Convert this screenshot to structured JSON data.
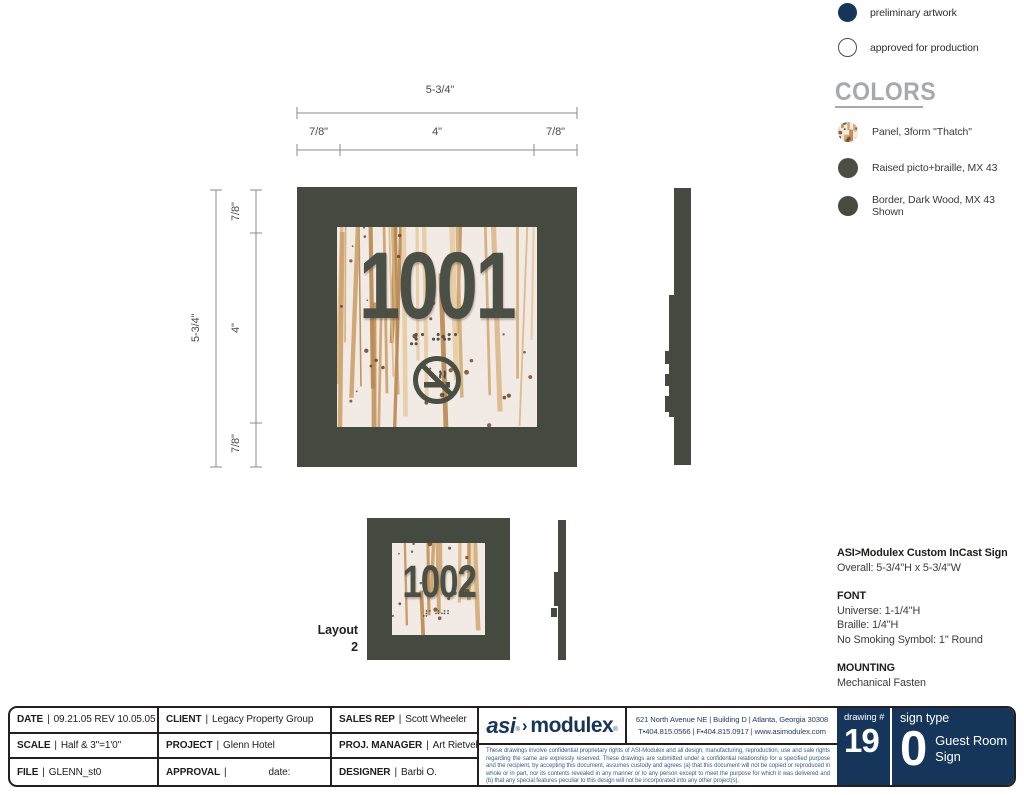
{
  "legend": {
    "preliminary": "preliminary artwork",
    "approved": "approved for production"
  },
  "colors": {
    "heading": "COLORS",
    "items": [
      {
        "label": "Panel, 3form \"Thatch\"",
        "swatch": "thatch"
      },
      {
        "label": "Raised picto+braille, MX 43",
        "swatch": "#4a4e44"
      },
      {
        "label": "Border, Dark Wood, MX 43 Shown",
        "swatch": "#474b41"
      }
    ]
  },
  "drawing": {
    "dims": {
      "overall_w": "5-3/4\"",
      "left_w": "7/8\"",
      "center_w": "4\"",
      "right_w": "7/8\"",
      "overall_h": "5-3/4\"",
      "top_h": "7/8\"",
      "center_h": "4\"",
      "bottom_h": "7/8\""
    },
    "main_sign": {
      "number": "1001"
    },
    "alt_sign": {
      "number": "1002",
      "layout_label": "Layout",
      "layout_number": "2"
    },
    "colors": {
      "border": "#454a40",
      "picto": "#4a4e44",
      "panel_bg": "#f2eae5"
    }
  },
  "specs": {
    "title": "ASI>Modulex Custom InCast Sign",
    "overall": "Overall: 5-3/4\"H x 5-3/4\"W",
    "font_heading": "FONT",
    "font_lines": [
      "Universe: 1-1/4\"H",
      "Braille: 1/4\"H",
      "No Smoking Symbol: 1\" Round"
    ],
    "mounting_heading": "MOUNTING",
    "mounting": "Mechanical Fasten"
  },
  "titleblock": {
    "sep": "|",
    "cells": [
      {
        "label": "DATE",
        "value": "09.21.05 REV 10.05.05"
      },
      {
        "label": "CLIENT",
        "value": "Legacy Property Group"
      },
      {
        "label": "SALES REP",
        "value": "Scott Wheeler"
      },
      {
        "label": "SCALE",
        "value": "Half & 3\"=1'0\""
      },
      {
        "label": "PROJECT",
        "value": "Glenn Hotel"
      },
      {
        "label": "PROJ. MANAGER",
        "value": "Art Rietveld"
      },
      {
        "label": "FILE",
        "value": "GLENN_st0"
      },
      {
        "label": "APPROVAL",
        "value": "date:"
      },
      {
        "label": "DESIGNER",
        "value": "Barbi O."
      }
    ],
    "logo": {
      "asi": "asi",
      "reg": "®",
      "arrow": "›",
      "modulex": "modulex"
    },
    "address": {
      "line1": "621 North Avenue NE | Building D | Atlanta, Georgia 30308",
      "line2": "T•404.815.0566 | F•404.815.0917 | www.asimodulex.com"
    },
    "fineprint": "These drawings involve confidential proprietary rights of ASI-Modulex and all design, manufacturing, reproduction, use and sale rights regarding the same are expressly reserved. These drawings are submitted under a confidential relationship for a specified purpose and the recipient, by accepting this document, assumes custody and agrees (a) that this document will not be copied or reproduced in whole or in part, nor its contents revealed in any manner or to any person except to meet the purpose for which it was delivered and (b) that any special features peculiar to this design will not be incorporated into any other project(s).",
    "drawing_number": {
      "label": "drawing #",
      "value": "19"
    },
    "sign_type": {
      "label": "sign type",
      "value": "0",
      "name_line1": "Guest Room",
      "name_line2": "Sign"
    },
    "navy": "#16355a"
  }
}
